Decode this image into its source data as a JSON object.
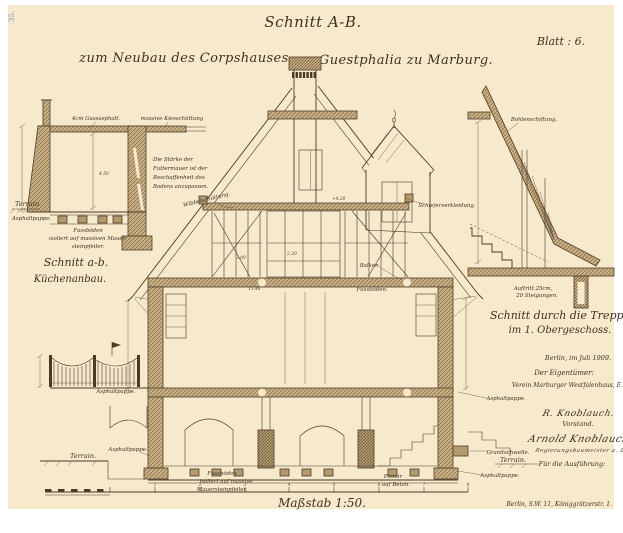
{
  "colors": {
    "paper": "#f6e9cc",
    "ink": "#4a3a26",
    "wall_tint": "#c9ae82"
  },
  "page": {
    "corner_stamp": "35.",
    "title": "Schnitt A-B.",
    "subtitle_left": "zum Neubau des Corpshauses",
    "subtitle_right": "Guestphalia zu Marburg.",
    "sheet_label": "Blatt : 6.",
    "scale_label": "Maßstab 1:50.",
    "printer_address": "Berlin, S.W. 11, Königgrätzerstr. 1."
  },
  "kitchen_detail": {
    "caption_line1": "Schnitt a-b.",
    "caption_line2": "Küchenanbau.",
    "label_gussasphalt": "4cm Gussasphalt.",
    "label_kiesschuettung": "massive Kiesschüttung",
    "note_line1": "Die Stärke der",
    "note_line2": "Futtermauer ist der",
    "note_line3": "Beschaffenheit des",
    "note_line4": "Bodens anzupassen.",
    "label_terrain": "Terrain.",
    "label_asphaltpappe": "Asphaltpappe.",
    "label_fussboden_line1": "Fussböden",
    "label_fussboden_line2": "isoliert auf massiven Mauer-",
    "label_fussboden_line3": "steinpfeiler.",
    "dim_room_height": "4.50"
  },
  "main_section": {
    "label_wibbelschuettung": "Wibbelschüttung.",
    "label_schieferverkleidung": "Schieferverkleidung.",
    "label_balken": "Balken.",
    "label_fussboeden": "Fussböden.",
    "label_asphaltpappe_left_upper": "Asphaltpappe.",
    "label_asphaltpappe_left_lower": "Asphaltpappe.",
    "label_terrain_left": "Terrain.",
    "label_fussboden_line1": "Fussböden",
    "label_fussboden_line2": "isoliert auf massive",
    "label_fussboden_line3": "Mauersteinpfeiler.",
    "label_pissoir_line1": "Pissoir",
    "label_pissoir_line2": "auf Beton.",
    "label_asphaltpappe_right_upper": "Asphaltpappe.",
    "label_granitschwelle": "Granitschwelle.",
    "label_terrain_right": "Terrain.",
    "label_asphaltpappe_right_lower": "Asphaltpappe.",
    "dim_attic_level": "+4.28",
    "dim_upper_room": "2.20",
    "dim_lower_room": "3.00",
    "dim_level": "13.48"
  },
  "stair_detail": {
    "label_bohlenschiftung": "Bohlenschiftung.",
    "label_auftritt_line1": "Auftritt 25cm,",
    "label_auftritt_line2": "20 Steigungen.",
    "caption_line1": "Schnitt durch die Treppe",
    "caption_line2": "im 1. Obergeschoss."
  },
  "title_block": {
    "date_line": "Berlin, im Juli 1909.",
    "owner_heading": "Der Eigentümer:",
    "owner_name": "Verein Marburger Westfalenhaus, E.V.",
    "signature_1": "R. Knoblauch.",
    "signature_1_role": "Vorstand.",
    "signature_2": "Arnold Knoblauch",
    "signature_2_role": "Regierungsbaumeister a. D.",
    "execution_heading": "Für die Ausführung:"
  },
  "scale_bar": {
    "tick_labels": [
      "1",
      "2",
      "3",
      "4",
      "5",
      "6",
      "7",
      "8"
    ]
  }
}
